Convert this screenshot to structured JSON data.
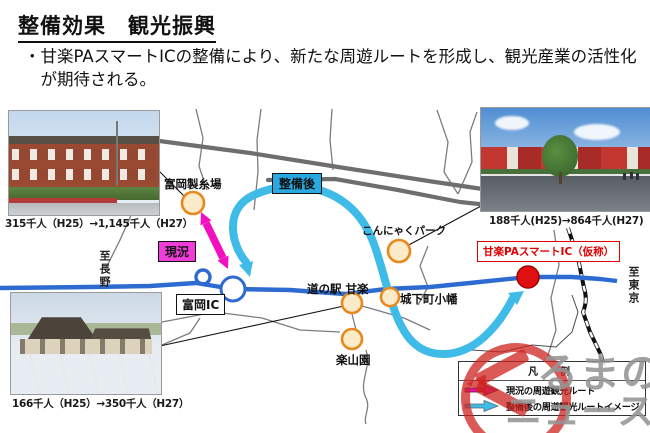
{
  "slide": {
    "title": "整備効果　観光振興",
    "bullet": "・甘楽PAスマートICの整備により、新たな周遊ルートを形成し、観光産業の活性化が期待される。"
  },
  "map": {
    "direction_left": "至長野",
    "direction_right": "至東京",
    "badges": {
      "current": "現況",
      "after": "整備後"
    },
    "pois": {
      "tomioka_mill": "富岡製糸場",
      "tomioka_ic": "富岡IC",
      "michinoeki_kanra": "道の駅 甘楽",
      "konnyaku_park": "こんにゃくパーク",
      "joukamachi_obata": "城下町小幡",
      "rakusanen": "楽山園",
      "kanra_pa_smart_ic": "甘楽PAスマートIC（仮称）"
    }
  },
  "photos": {
    "tomioka_mill_caption": "315千人（H25）→1,145千人（H27）",
    "konnyaku_park_caption": "188千人(H25)→864千人(H27)",
    "michinoeki_caption": "166千人（H25）→350千人（H27）"
  },
  "legend": {
    "title": "凡　例",
    "items": [
      {
        "label": "現況の周遊観光ルート",
        "color": "#f10fc0"
      },
      {
        "label": "整備後の周遊観光ルートイメージ",
        "color": "#3fbbe8"
      }
    ]
  },
  "watermark": {
    "line1": "るまの",
    "line2": "ニュース"
  },
  "colors": {
    "route_current": "#f10fc0",
    "route_after": "#3fbbe8",
    "expressway_blue": "#2e6bd0",
    "major_road_gray": "#6e6e6e",
    "poi_fill": "#fcebc8",
    "poi_border": "#e8881e",
    "smart_ic_red": "#e01010"
  }
}
